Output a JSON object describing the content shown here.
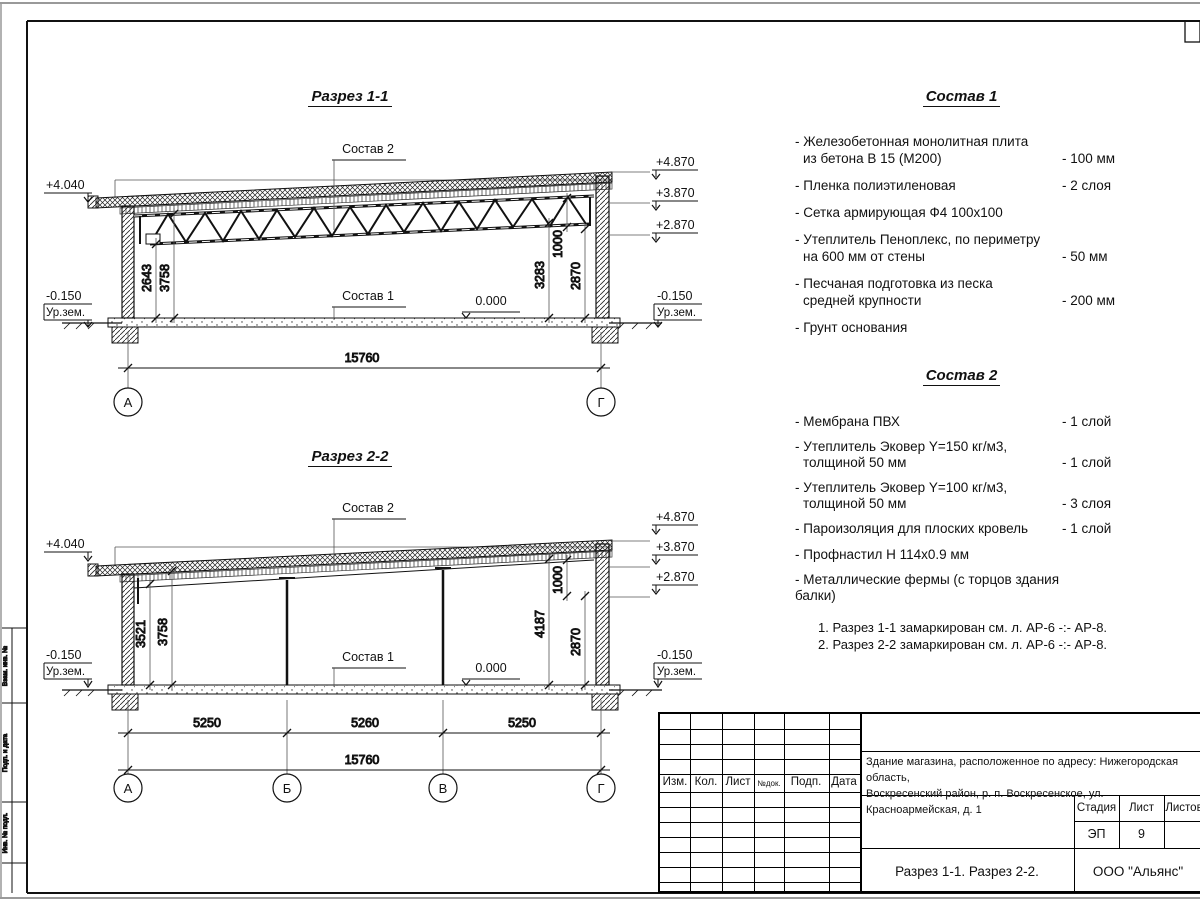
{
  "sheet": {
    "marks": {
      "plus4040": "+4.040",
      "plus4870": "+4.870",
      "plus3870": "+3.870",
      "plus2870": "+2.870",
      "minus0150": "-0.150",
      "ground": "Ур.зем.",
      "zero": "0.000"
    },
    "section1": {
      "title": "Разрез 1-1",
      "sostav2_ref": "Состав 2",
      "sostav1_ref": "Состав 1",
      "dims": {
        "d2643": "2643",
        "d3758": "3758",
        "d3283": "3283",
        "d1000": "1000",
        "d2870": "2870",
        "total": "15760"
      },
      "axes": {
        "left": "А",
        "right": "Г"
      }
    },
    "section2": {
      "title": "Разрез 2-2",
      "sostav2_ref": "Состав 2",
      "sostav1_ref": "Состав 1",
      "dims": {
        "d3521": "3521",
        "d3758": "3758",
        "d4187": "4187",
        "d1000": "1000",
        "d2870": "2870",
        "b1": "5250",
        "b2": "5260",
        "b3": "5250",
        "total": "15760"
      },
      "axes": {
        "a": "А",
        "b": "Б",
        "v": "В",
        "g": "Г"
      }
    },
    "sostav1": {
      "title": "Состав 1",
      "items": [
        {
          "line1": "- Железобетонная  монолитная плита",
          "line2": "из бетона В 15 (М200)",
          "value": "- 100 мм"
        },
        {
          "line1": "- Пленка полиэтиленовая",
          "line2": "",
          "value": "-  2 слоя"
        },
        {
          "line1": "- Сетка армирующая Ф4 100х100",
          "line2": "",
          "value": ""
        },
        {
          "line1": "- Утеплитель Пеноплекс, по периметру",
          "line2": "на 600 мм от стены",
          "value": "- 50 мм"
        },
        {
          "line1": "- Песчаная подготовка из песка",
          "line2": "средней крупности",
          "value": "- 200 мм"
        },
        {
          "line1": "- Грунт основания",
          "line2": "",
          "value": ""
        }
      ]
    },
    "sostav2": {
      "title": "Состав 2",
      "items": [
        {
          "line1": "- Мембрана ПВХ",
          "line2": "",
          "value": "- 1 слой"
        },
        {
          "line1": "- Утеплитель Эковер Y=150 кг/м3,",
          "line2": "толщиной 50 мм",
          "value": "- 1 слой"
        },
        {
          "line1": "- Утеплитель Эковер Y=100 кг/м3,",
          "line2": "толщиной 50 мм",
          "value": "- 3 слоя"
        },
        {
          "line1": "- Пароизоляция для плоских кровель",
          "line2": "",
          "value": "- 1 слой"
        },
        {
          "line1": "- Профнастил Н 114х0.9 мм",
          "line2": "",
          "value": ""
        },
        {
          "line1": "- Металлические фермы (с торцов здания балки)",
          "line2": "",
          "value": ""
        }
      ]
    },
    "notes": {
      "n1": "1. Разрез 1-1 замаркирован см. л. АР-6 -:- АР-8.",
      "n2": "2. Разрез 2-2 замаркирован см. л. АР-6 -:- АР-8."
    },
    "titleblock": {
      "col_izm": "Изм.",
      "col_kol": "Кол.",
      "col_list": "Лист",
      "col_ndok": "№док.",
      "col_podp": "Подп.",
      "col_data": "Дата",
      "project_line1": "Здание магазина, расположенное по адресу: Нижегородская область,",
      "project_line2": "Воскресенский район, р. п. Воскресенское, ул. Красноармейская, д. 1",
      "stage_label": "Стадия",
      "sheet_label": "Лист",
      "sheets_label": "Листов",
      "stage_value": "ЭП",
      "sheet_value": "9",
      "sheets_value": "",
      "doc_title": "Разрез 1-1. Разрез 2-2.",
      "company": "ООО \"Альянс\""
    },
    "frame": {
      "side1": "Взам. инв. №",
      "side2": "Подп. и дата",
      "side3": "Инв. № подл."
    }
  }
}
